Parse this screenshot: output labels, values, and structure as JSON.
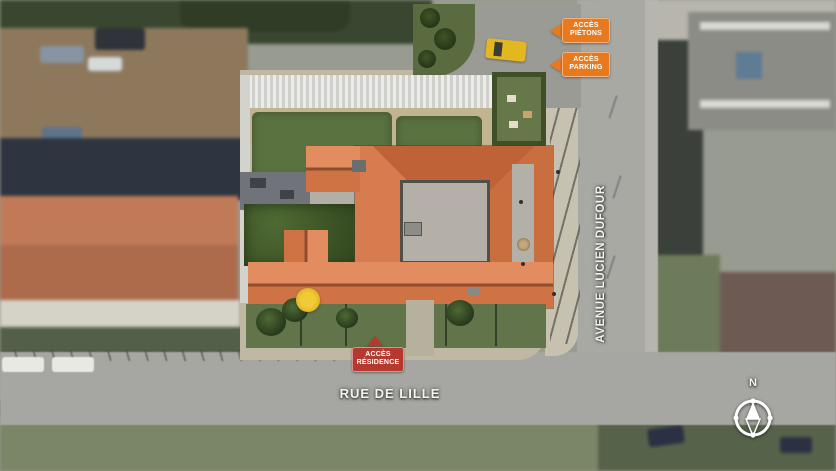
{
  "streets": {
    "rue_de_lille": "RUE DE LILLE",
    "avenue_lucien_dufour": "AVENUE LUCIEN DUFOUR"
  },
  "access_signs": {
    "pietons": "ACCÈS PIÉTONS",
    "parking": "ACCÈS PARKING",
    "residence": "ACCÈS RÉSIDENCE"
  },
  "compass": {
    "north": "N"
  },
  "colors": {
    "access_orange": "#E8791D",
    "access_red": "#B5392E",
    "roof_terracotta": "#D97C4E",
    "lawn_green": "#5A7140",
    "road_grey": "#A7A7A2",
    "paving_beige": "#C0B8A2",
    "car_yellow": "#E2B71F"
  }
}
